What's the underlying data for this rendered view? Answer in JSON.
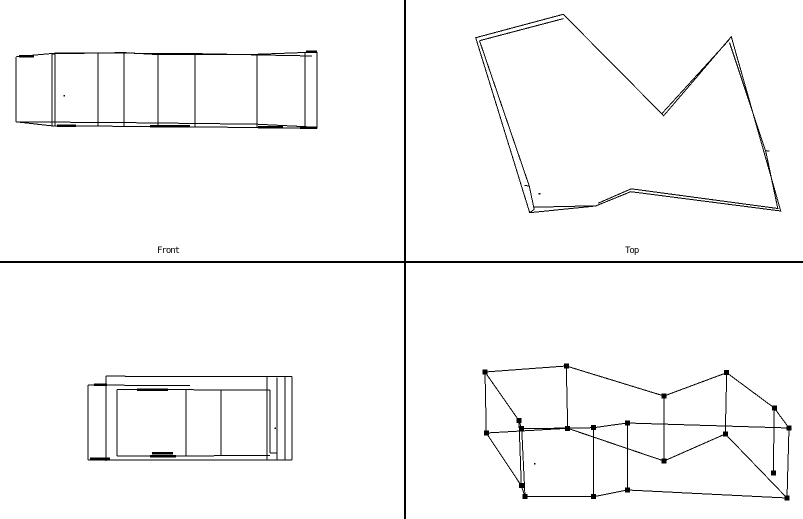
{
  "window": {
    "width": 803,
    "height": 519,
    "background": "#ffffff",
    "line_color": "#000000",
    "marker_color": "#000000",
    "marker_size": 5
  },
  "dividers": [
    {
      "name": "vertical-splitter",
      "line": [
        405,
        0,
        405,
        519
      ],
      "thickness": 2
    },
    {
      "name": "horizontal-splitter",
      "line": [
        0,
        262,
        803,
        262
      ],
      "thickness": 2
    }
  ],
  "viewports": [
    {
      "name": "front",
      "label": "Front",
      "lines": [
        [
          16,
          56.8,
          16,
          121.8
        ],
        [
          52,
          53.8,
          52,
          126.0
        ],
        [
          55,
          53.2,
          55,
          126.2
        ],
        [
          98,
          53.6,
          98,
          126.4
        ],
        [
          124,
          52.8,
          124,
          126.3
        ],
        [
          158,
          54.2,
          158,
          126.9
        ],
        [
          195,
          53.8,
          195,
          127.0
        ],
        [
          257,
          54.4,
          257,
          127.3
        ],
        [
          305,
          52.3,
          305,
          127.9
        ],
        [
          317,
          51.8,
          317,
          128.3
        ],
        [
          16,
          56.8,
          55,
          53.2
        ],
        [
          16,
          121.8,
          55,
          126.2
        ]
      ],
      "polylines": [
        {
          "points": [
            [
              52,
              53.8
            ],
            [
              124,
              52.6
            ],
            [
              158,
              54.6
            ],
            [
              257,
              54.3
            ],
            [
              317,
              52.0
            ]
          ],
          "closed": false
        },
        {
          "points": [
            [
              55,
              52.8
            ],
            [
              195,
              53.6
            ],
            [
              312,
              56.0
            ]
          ],
          "closed": false
        },
        {
          "points": [
            [
              52,
              125.8
            ],
            [
              158,
              126.6
            ],
            [
              317,
              128.1
            ]
          ],
          "closed": false
        },
        {
          "points": [
            [
              16,
              121.9
            ],
            [
              124,
              122.6
            ],
            [
              257,
              124.2
            ],
            [
              317,
              127.3
            ]
          ],
          "closed": false
        }
      ],
      "thick_lines": [
        [
          19,
          56.2,
          34,
          56.2
        ],
        [
          306,
          51.8,
          317,
          51.8
        ],
        [
          57,
          125.7,
          76,
          125.7
        ],
        [
          150,
          126.3,
          190,
          126.3
        ],
        [
          258,
          127.1,
          283,
          127.1
        ],
        [
          300,
          127.9,
          317,
          127.9
        ]
      ],
      "dots": [
        [
          64.5,
          96
        ]
      ]
    },
    {
      "name": "top",
      "label": "Top",
      "lines": [
        [
          524.3,
          185.2,
          529.2,
          186.2
        ],
        [
          765.0,
          150.5,
          769.5,
          151.2
        ],
        [
          529.7,
          212.7,
          534.2,
          209.3
        ]
      ],
      "polylines": [
        {
          "points": [
            [
              475.7,
              37.7
            ],
            [
              563.3,
              14.3
            ],
            [
              663.7,
              115.7
            ],
            [
              731.3,
              36.7
            ],
            [
              780.7,
              211.0
            ],
            [
              630.7,
              191.7
            ],
            [
              595.7,
              206.0
            ],
            [
              529.7,
              212.7
            ]
          ],
          "closed": true
        },
        {
          "points": [
            [
              479.5,
              40.7
            ],
            [
              563.5,
              18.6
            ]
          ],
          "closed": false
        },
        {
          "points": [
            [
              662.0,
              113.5
            ],
            [
              728.5,
              40.5
            ]
          ],
          "closed": false
        },
        {
          "points": [
            [
              729.5,
              42.5
            ],
            [
              765.8,
              151.5
            ],
            [
              777.8,
              208.5
            ],
            [
              631.2,
              188.8
            ],
            [
              598.2,
              203.2
            ]
          ],
          "closed": false
        },
        {
          "points": [
            [
              594.5,
              205.8
            ],
            [
              534.2,
              207.2
            ]
          ],
          "closed": false
        },
        {
          "points": [
            [
              534.2,
              209.3
            ],
            [
              529.2,
              185.8
            ],
            [
              479.5,
              40.7
            ]
          ],
          "closed": false
        }
      ],
      "thick_lines": [],
      "dots": [
        [
          539.7,
          194.0
        ]
      ]
    },
    {
      "name": "side",
      "label": null,
      "lines": [
        [
          88,
          385.0,
          88,
          459.8
        ],
        [
          106,
          376.2,
          106,
          460.8
        ],
        [
          117,
          389.3,
          117,
          456.2
        ],
        [
          186,
          389.6,
          186,
          456.0
        ],
        [
          221,
          389.8,
          221,
          455.6
        ],
        [
          267,
          376.4,
          267,
          460.4
        ],
        [
          270,
          390.0,
          270,
          453.2
        ],
        [
          277,
          377.6,
          277,
          459.9
        ],
        [
          285,
          377.0,
          285,
          459.9
        ],
        [
          292,
          376.5,
          292,
          459.9
        ],
        [
          106,
          376.2,
          292,
          376.7
        ],
        [
          88,
          385.0,
          190,
          385.7
        ],
        [
          117,
          389.4,
          270,
          390.1
        ],
        [
          117,
          456.2,
          270,
          455.5
        ],
        [
          270,
          453.2,
          277,
          452.9
        ],
        [
          88,
          459.8,
          292,
          460.1
        ]
      ],
      "polylines": [],
      "thick_lines": [
        [
          94,
          384.9,
          107,
          384.9
        ],
        [
          137,
          389.7,
          168,
          389.7
        ],
        [
          150,
          456.0,
          176,
          456.0
        ],
        [
          152,
          453.4,
          173,
          453.4
        ],
        [
          90,
          458.9,
          110,
          458.9
        ]
      ],
      "dots": [
        [
          275.3,
          428.3
        ]
      ]
    },
    {
      "name": "perspective",
      "label": null,
      "lines": [
        [
          485,
          372,
          486.3,
          433
        ],
        [
          566.3,
          366,
          567.7,
          428.3
        ],
        [
          664,
          396,
          664,
          461
        ],
        [
          726.7,
          372.7,
          725.3,
          434
        ],
        [
          774.3,
          408,
          773.3,
          473
        ],
        [
          789,
          428,
          787,
          498
        ],
        [
          627.3,
          423,
          627.3,
          490
        ],
        [
          593.7,
          427.7,
          593.7,
          496.7
        ],
        [
          521.7,
          428.7,
          525,
          496.7
        ],
        [
          519,
          420.7,
          521.3,
          485.7
        ]
      ],
      "polylines": [
        {
          "points": [
            [
              485,
              372
            ],
            [
              566.3,
              366
            ],
            [
              664,
              396
            ],
            [
              726.7,
              372.7
            ],
            [
              774.3,
              408
            ],
            [
              789,
              428
            ],
            [
              627.3,
              423
            ],
            [
              593.7,
              427.7
            ],
            [
              521.7,
              428.7
            ],
            [
              519,
              420.7
            ]
          ],
          "closed": true
        },
        {
          "points": [
            [
              486.3,
              433
            ],
            [
              567.7,
              428.3
            ],
            [
              664,
              461
            ],
            [
              725.3,
              434
            ],
            [
              787,
              498
            ],
            [
              627.3,
              490
            ],
            [
              593.7,
              496.7
            ],
            [
              525,
              496.7
            ],
            [
              521.3,
              485.7
            ]
          ],
          "closed": true
        }
      ],
      "thick_lines": [],
      "markers": [
        [
          485,
          372
        ],
        [
          566.3,
          366
        ],
        [
          664,
          396
        ],
        [
          726.7,
          372.7
        ],
        [
          774.3,
          408
        ],
        [
          789,
          428
        ],
        [
          627.3,
          423
        ],
        [
          593.7,
          427.7
        ],
        [
          521.7,
          428.7
        ],
        [
          519,
          420.7
        ],
        [
          486.3,
          433
        ],
        [
          567.7,
          428.3
        ],
        [
          664,
          461
        ],
        [
          725.3,
          434
        ],
        [
          773.3,
          473
        ],
        [
          787,
          498
        ],
        [
          627.3,
          490
        ],
        [
          593.7,
          496.7
        ],
        [
          525,
          496.7
        ],
        [
          521.3,
          485.7
        ]
      ],
      "dots": [
        [
          535,
          464
        ]
      ]
    }
  ]
}
